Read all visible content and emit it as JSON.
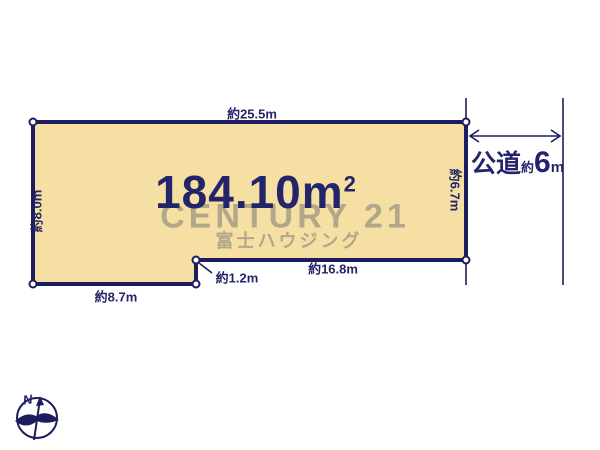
{
  "colors": {
    "background": "#ffffff",
    "plot_fill": "#F6DFA2",
    "plot_border": "#1C1D5E",
    "label_text": "#24246B",
    "watermark": "#B1A78B"
  },
  "plot": {
    "area_value": "184.10m",
    "area_superscript": "2",
    "dimensions": {
      "top": "約25.5m",
      "left": "約8.0m",
      "bottom_left": "約8.7m",
      "notch": "約1.2m",
      "bottom_right": "約16.8m",
      "right": "約6.7m"
    }
  },
  "road": {
    "type": "公道",
    "approx": "約",
    "width_value": "6",
    "unit": "m"
  },
  "watermark": {
    "brand": "CENTURY 21",
    "company": "富士ハウジング"
  },
  "compass": {
    "north_label": "N"
  }
}
